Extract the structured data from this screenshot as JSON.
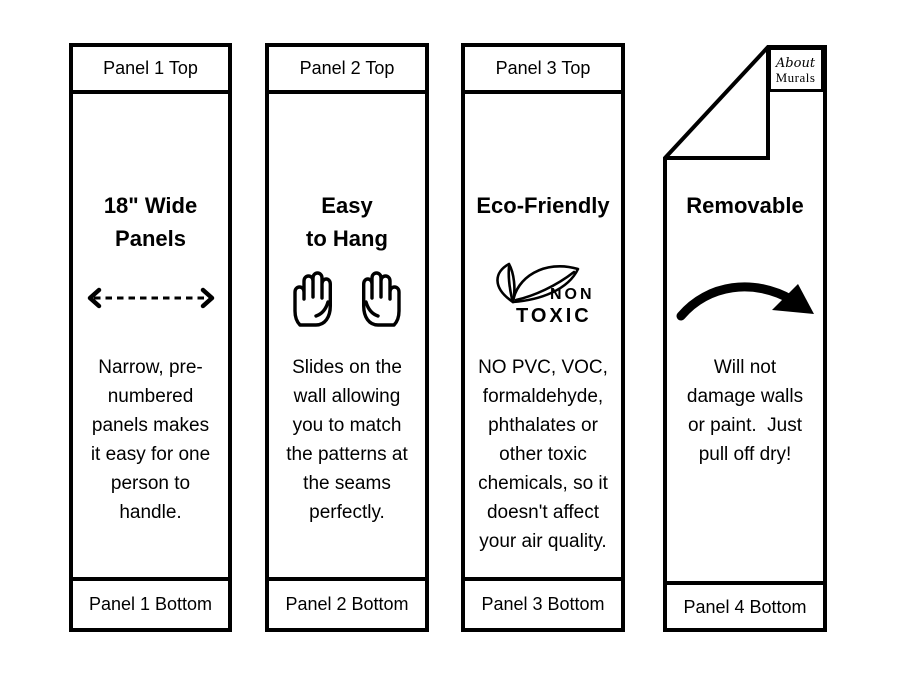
{
  "canvas": {
    "width": 900,
    "height": 675,
    "background": "#ffffff",
    "ink": "#000000"
  },
  "panels": [
    {
      "top_label": "Panel 1 Top",
      "heading": "18\" Wide\nPanels",
      "icon": "double-headed-dashed-arrow",
      "body": "Narrow, pre-\nnumbered\npanels makes\nit easy for one\nperson to\nhandle.",
      "bottom_label": "Panel 1 Bottom"
    },
    {
      "top_label": "Panel 2 Top",
      "heading": "Easy\nto Hang",
      "icon": "raised-hand-pair",
      "body": "Slides on the\nwall allowing\nyou to match\nthe patterns at\nthe seams\nperfectly.",
      "bottom_label": "Panel 2 Bottom"
    },
    {
      "top_label": "Panel 3 Top",
      "heading": "Eco-Friendly",
      "icon": "non-toxic-leaves",
      "icon_label_top": "NON",
      "icon_label_bottom": "TOXIC",
      "body": "NO PVC, VOC,\nformaldehyde,\nphthalates or\nother toxic\nchemicals, so it\ndoesn't affect\nyour air quality.",
      "bottom_label": "Panel 3 Bottom"
    },
    {
      "fold": "top-left-folded-corner",
      "logo_top": "About",
      "logo_bottom": "Murals",
      "heading": "Removable",
      "icon": "curved-swoosh-arrow",
      "body": "Will not\ndamage walls\nor paint.  Just\npull off dry!",
      "bottom_label": "Panel 4 Bottom"
    }
  ]
}
